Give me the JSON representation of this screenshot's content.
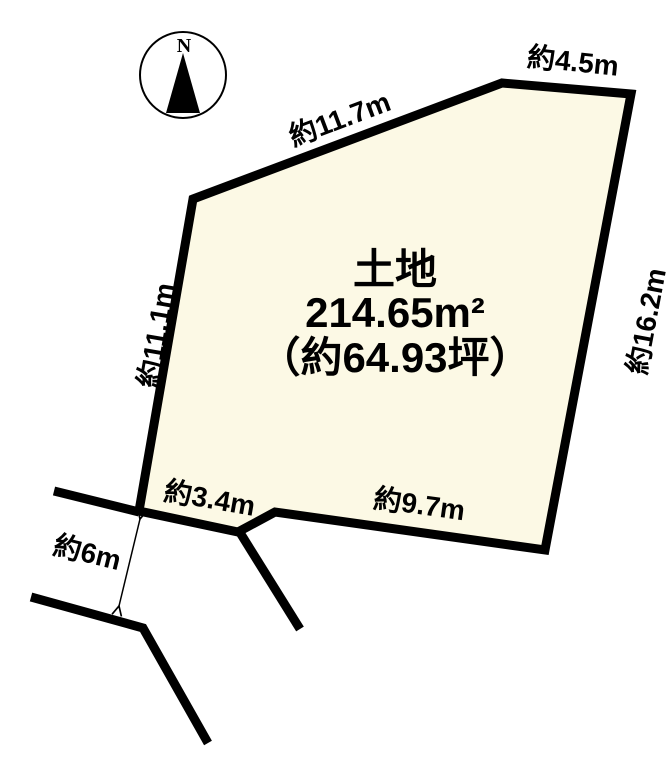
{
  "colors": {
    "background": "#ffffff",
    "parcel_fill": "#fcf9e5",
    "line": "#000000"
  },
  "compass": {
    "north_label": "N"
  },
  "parcel": {
    "title": "土地",
    "area_m2": "214.65m²",
    "area_tsubo": "（約64.93坪）"
  },
  "dimensions": {
    "top_edge": "約11.7m",
    "top_right_edge": "約4.5m",
    "left_edge": "約11.1m",
    "right_edge": "約16.2m",
    "bottom_left_edge": "約3.4m",
    "bottom_edge": "約9.7m",
    "road_width": "約6m"
  }
}
